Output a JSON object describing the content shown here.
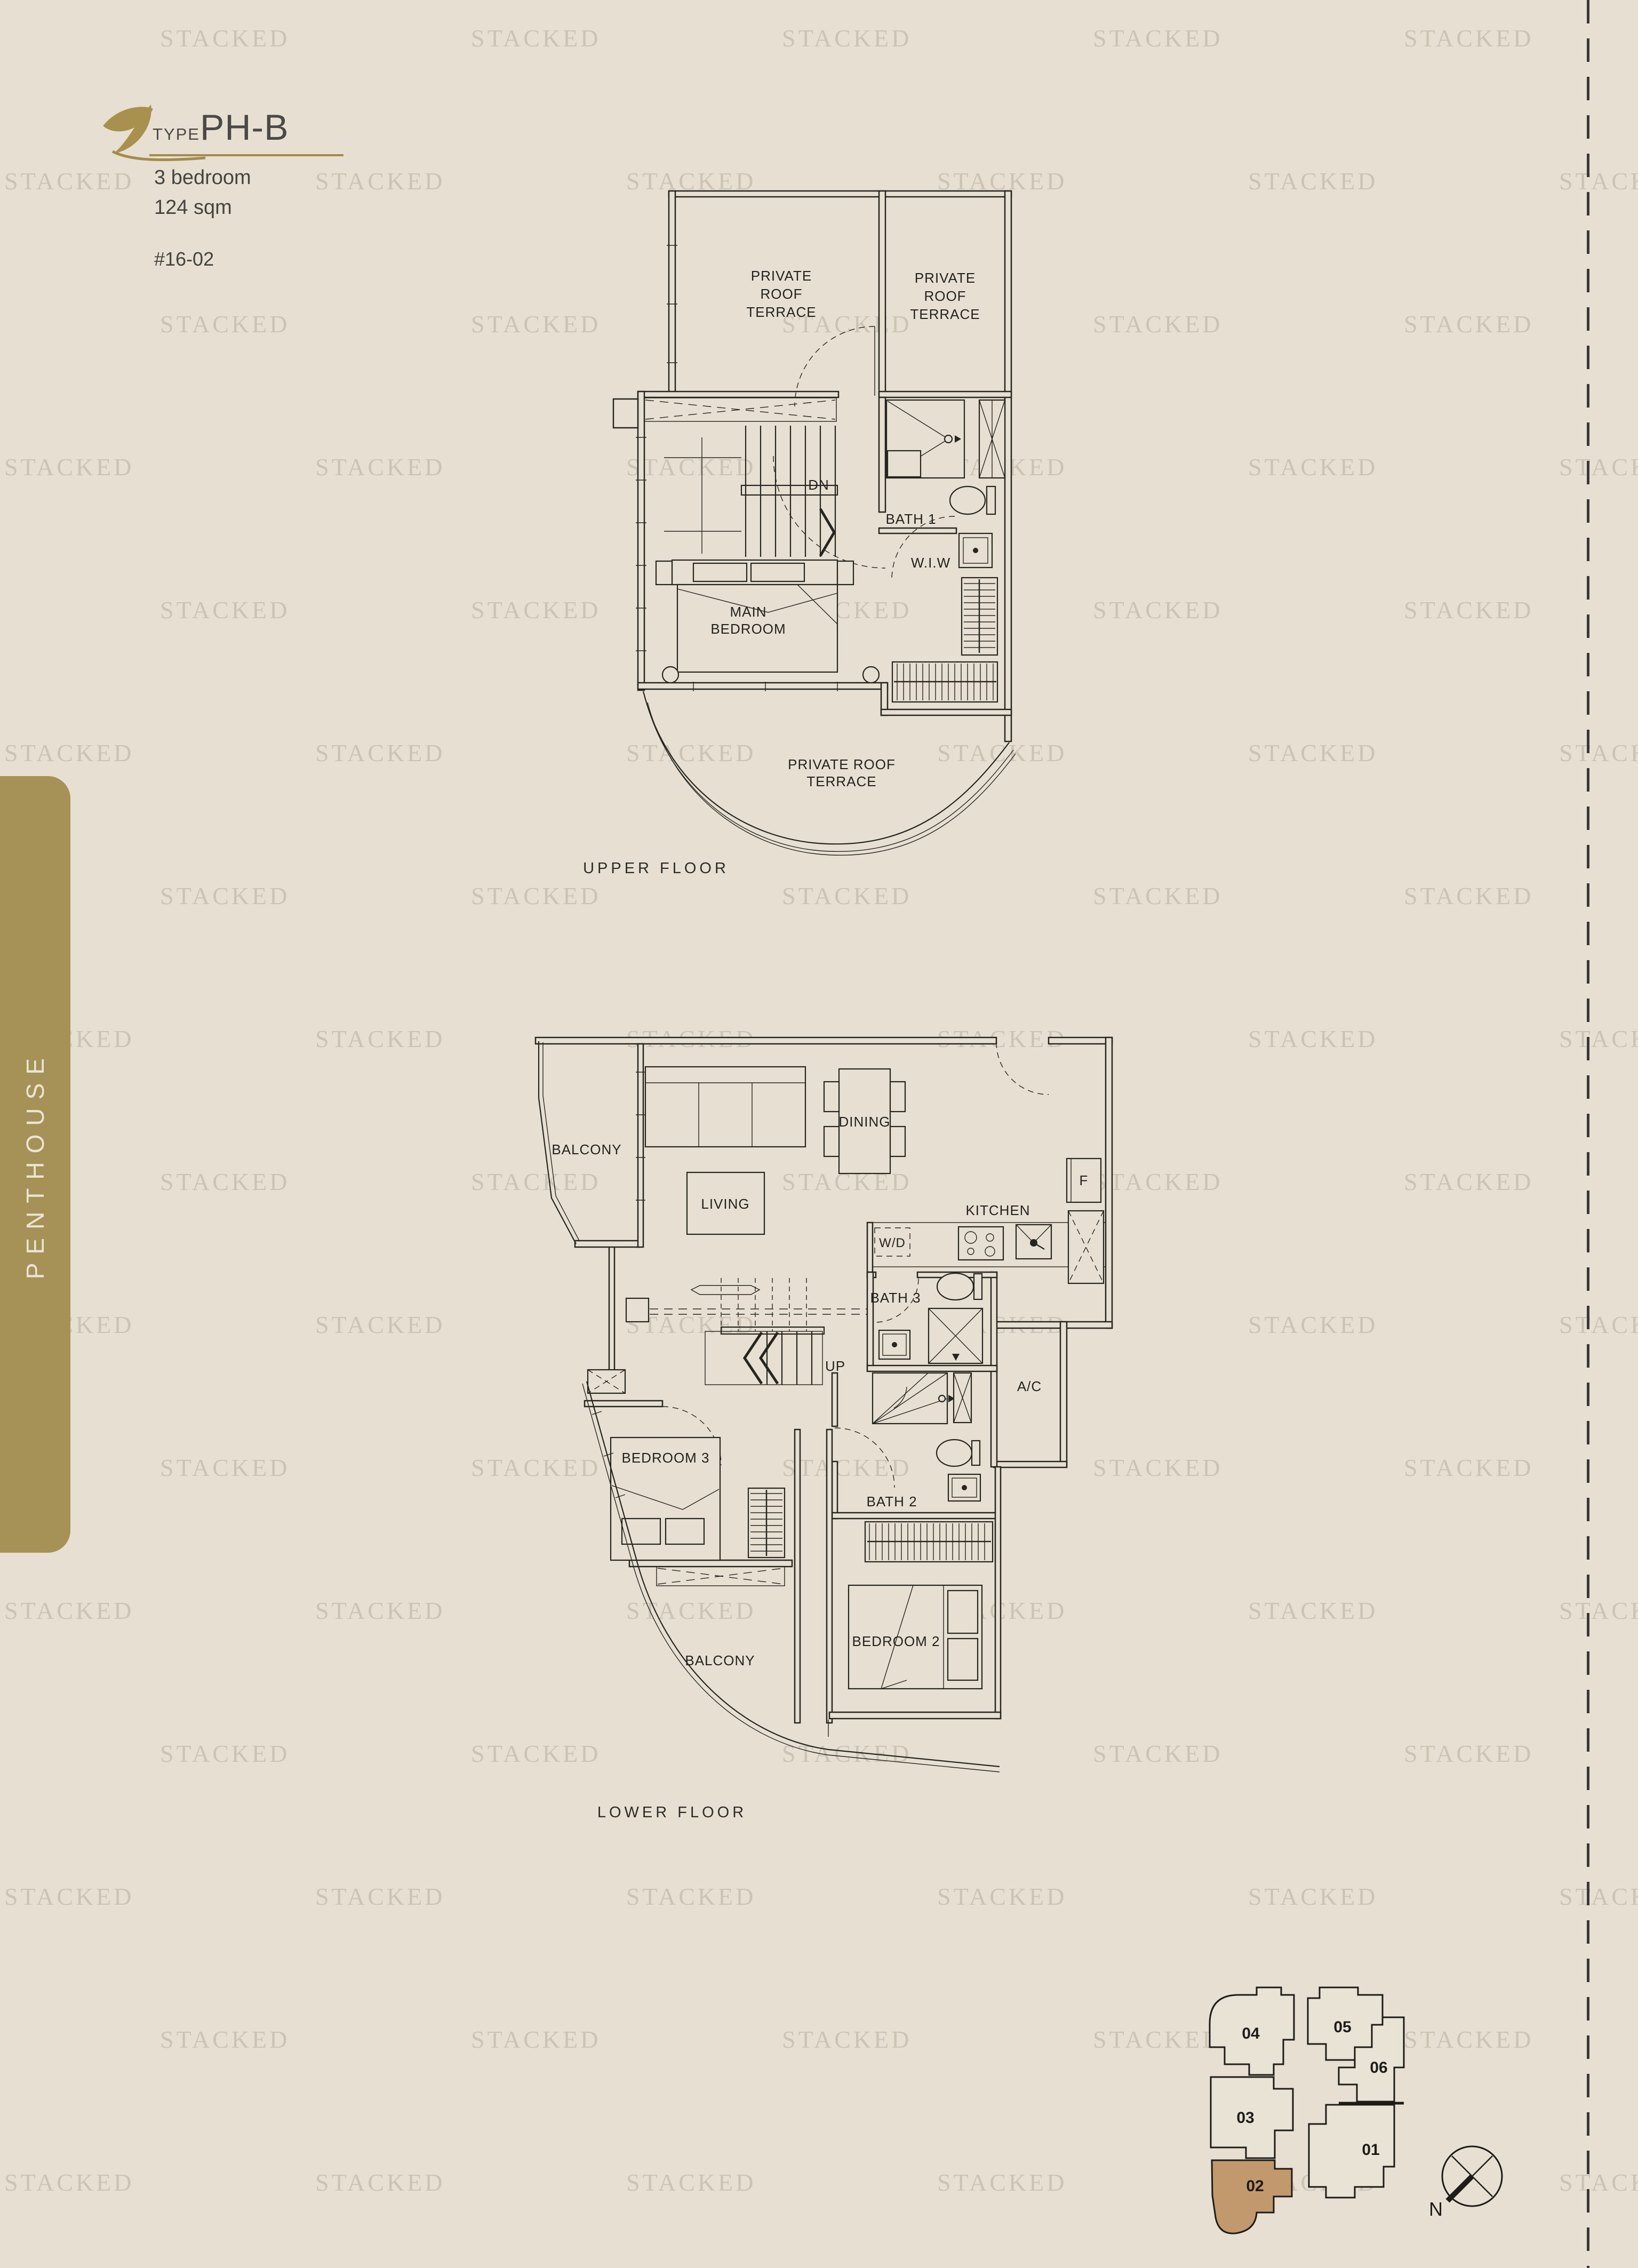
{
  "page": {
    "watermark_text": "STACKED"
  },
  "header": {
    "type_label": "TYPE",
    "type_value": "PH-B",
    "spec_line1": "3 bedroom",
    "spec_line2": "124 sqm",
    "unit_number": "#16-02"
  },
  "sidebar": {
    "label": "PENTHOUSE"
  },
  "upper_floor": {
    "caption": "UPPER FLOOR",
    "labels": {
      "terrace_left": [
        "PRIVATE",
        "ROOF",
        "TERRACE"
      ],
      "terrace_right": [
        "PRIVATE",
        "ROOF",
        "TERRACE"
      ],
      "terrace_bottom": [
        "PRIVATE ROOF",
        "TERRACE"
      ],
      "dn": "DN",
      "bath1": "BATH 1",
      "wiw": "W.I.W",
      "main_bedroom": [
        "MAIN",
        "BEDROOM"
      ]
    }
  },
  "lower_floor": {
    "caption": "LOWER FLOOR",
    "labels": {
      "balcony_top": "BALCONY",
      "living": "LIVING",
      "dining": "DINING",
      "kitchen": "KITCHEN",
      "wd": "W/D",
      "fridge": "F",
      "bath3": "BATH 3",
      "up": "UP",
      "ac": "A/C",
      "bath2": "BATH 2",
      "bedroom3": "BEDROOM 3",
      "bedroom2": "BEDROOM 2",
      "balcony_bottom": "BALCONY"
    }
  },
  "unit_diagram": {
    "units": [
      {
        "label": "04",
        "highlighted": false
      },
      {
        "label": "05",
        "highlighted": false
      },
      {
        "label": "06",
        "highlighted": false
      },
      {
        "label": "03",
        "highlighted": false
      },
      {
        "label": "01",
        "highlighted": false
      },
      {
        "label": "02",
        "highlighted": true
      }
    ],
    "highlight_color": "#c2996c",
    "compass_north": "N"
  }
}
